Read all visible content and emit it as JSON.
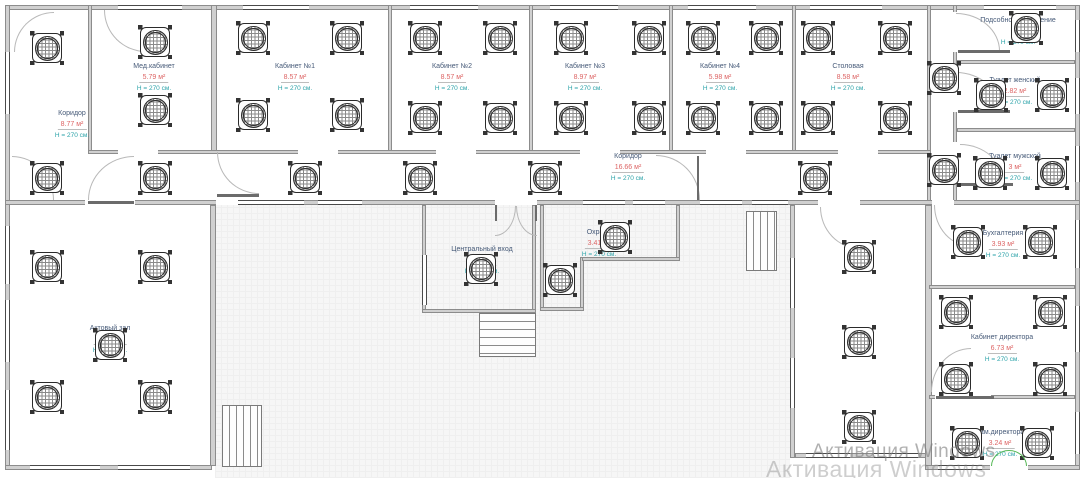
{
  "watermark": {
    "line1": "Активация Windows",
    "line2": "Активация Windows"
  },
  "colors": {
    "room_name": "#465a78",
    "room_area": "#dd6565",
    "room_height": "#2aa2a8",
    "wall": "#d0d0d0",
    "door_green": "#57b957"
  },
  "rooms": {
    "corridor_left": {
      "name": "Коридор",
      "area": "8.77 м²",
      "height": "Н = 270 см."
    },
    "med_office": {
      "name": "Мед.кабинет",
      "area": "5.79 м²",
      "height": "Н = 270 см."
    },
    "office1": {
      "name": "Кабинет №1",
      "area": "8.57 м²",
      "height": "Н = 270 см."
    },
    "office2": {
      "name": "Кабинет №2",
      "area": "8.57 м²",
      "height": "Н = 270 см."
    },
    "office3": {
      "name": "Кабинет №3",
      "area": "8.97 м²",
      "height": "Н = 270 см."
    },
    "office4": {
      "name": "Кабинет №4",
      "area": "5.98 м²",
      "height": "Н = 270 см."
    },
    "dining": {
      "name": "Столовая",
      "area": "8.58 м²",
      "height": "Н = 270 см."
    },
    "utility": {
      "name": "Подсобное помещение",
      "area": "",
      "height": "Н = 270 см."
    },
    "wc_women": {
      "name": "Туалет женский",
      "area": "2.82 м²",
      "height": "Н = 270 см."
    },
    "wc_men": {
      "name": "Туалет мужской",
      "area": "3 м²",
      "height": "Н = 270 см."
    },
    "corridor_main": {
      "name": "Коридор",
      "area": "16.66 м²",
      "height": "Н = 270 см."
    },
    "entrance": {
      "name": "Центральный вход",
      "area": "4.01 м²",
      "height": "Н = 270 см."
    },
    "security": {
      "name": "Охрана",
      "area": "3.41 м²",
      "height": "Н = 270 см."
    },
    "assembly_hall": {
      "name": "Актовый зал",
      "area": "18.98 м²",
      "height": "Н = 270 см."
    },
    "accounting": {
      "name": "Бухгалтерия",
      "area": "3.93 м²",
      "height": "Н = 270 см."
    },
    "director": {
      "name": "Кабинет директора",
      "area": "6.73 м²",
      "height": "Н = 270 см."
    },
    "deputy": {
      "name": "Зам.директора",
      "area": "3.24 м²",
      "height": "Н = 270 см."
    }
  }
}
